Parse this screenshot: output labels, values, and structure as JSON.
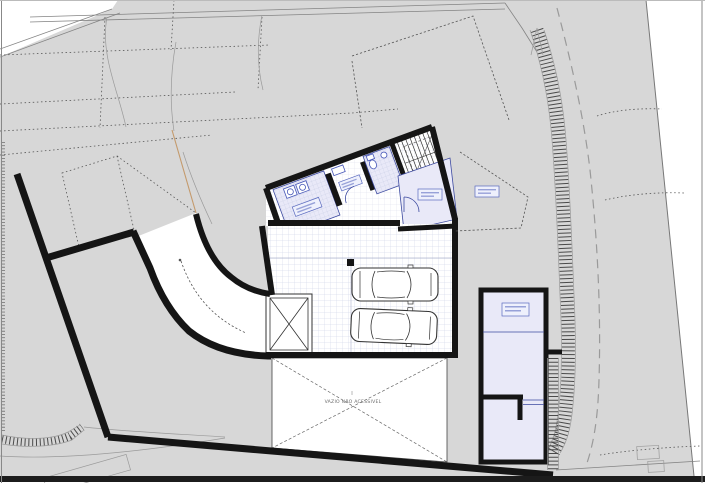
{
  "drawing": {
    "kind": "architectural basement / site plan",
    "void_label": "VAZIO NÃO ACESSIVEL",
    "cars_count": 2,
    "room_label_boxes": {
      "count": 6,
      "legible": false
    },
    "features": [
      "terrain with survey lines",
      "curved driveway ramp",
      "garage with two cars",
      "staircase",
      "elevator shaft",
      "inaccessible void",
      "side annex",
      "retaining wall hatch"
    ]
  },
  "colors": {
    "paper": "#ffffff",
    "terrain": "#d7d7d7",
    "wall": "#151515",
    "room_fill": "#e9e9f8",
    "tile_grid": "#b9c2dc",
    "label_fill": "#eef0fc",
    "label_border": "#5a6abf",
    "ramp_tan": "#c49a6c",
    "dashed_road": "#9a9a9a",
    "bottom_bar": "#1c1c1c"
  }
}
